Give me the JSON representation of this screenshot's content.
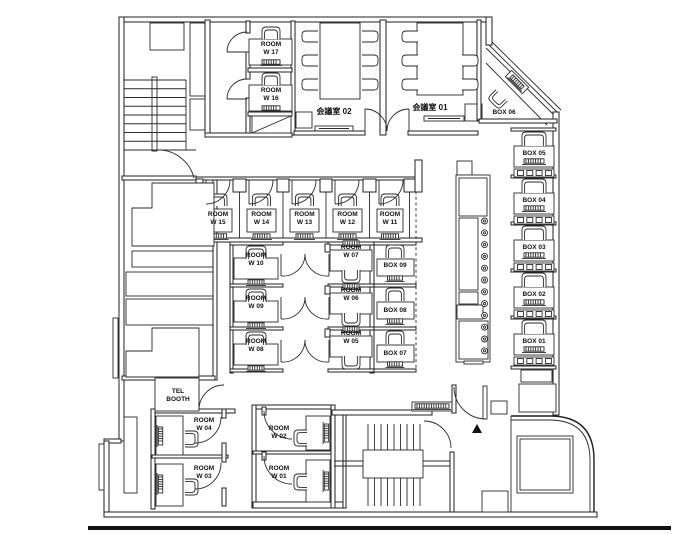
{
  "diagram": {
    "type": "office-floor-plan",
    "entrance_marker": "▲",
    "colors": {
      "wall": "#1f1f1f",
      "floor": "#ffffff",
      "marker": "#000000"
    }
  },
  "rooms_summary": {
    "work_rooms": [
      "ROOM W 01",
      "ROOM W 02",
      "ROOM W 03",
      "ROOM W 04",
      "ROOM W 05",
      "ROOM W 06",
      "ROOM W 07",
      "ROOM W 08",
      "ROOM W 09",
      "ROOM W 10",
      "ROOM W 11",
      "ROOM W 12",
      "ROOM W 13",
      "ROOM W 14",
      "ROOM W 15",
      "ROOM W 16",
      "ROOM W 17"
    ],
    "box_seats": [
      "BOX 01",
      "BOX 02",
      "BOX 03",
      "BOX 04",
      "BOX 05",
      "BOX 06",
      "BOX 07",
      "BOX 08",
      "BOX 09"
    ],
    "meeting_rooms": [
      "会議室 01",
      "会議室 02"
    ],
    "phone_booth": "TEL BOOTH"
  },
  "labels": [
    {
      "name": "room-w17-label",
      "text": "ROOM\nW 17",
      "x": 271,
      "y": 41
    },
    {
      "name": "room-w16-label",
      "text": "ROOM\nW 16",
      "x": 271,
      "y": 87
    },
    {
      "name": "meeting-room-02-label",
      "text": "会議室 02",
      "x": 334,
      "y": 107,
      "fs": 8
    },
    {
      "name": "meeting-room-01-label",
      "text": "会議室 01",
      "x": 430,
      "y": 103,
      "fs": 8
    },
    {
      "name": "box-06-label",
      "text": "BOX 06",
      "x": 504,
      "y": 109
    },
    {
      "name": "box-05-label",
      "text": "BOX 05",
      "x": 534,
      "y": 150
    },
    {
      "name": "box-04-label",
      "text": "BOX 04",
      "x": 534,
      "y": 197
    },
    {
      "name": "box-03-label",
      "text": "BOX 03",
      "x": 534,
      "y": 244
    },
    {
      "name": "box-02-label",
      "text": "BOX 02",
      "x": 534,
      "y": 291
    },
    {
      "name": "box-01-label",
      "text": "BOX 01",
      "x": 534,
      "y": 338
    },
    {
      "name": "room-w15-label",
      "text": "ROOM\nW 15",
      "x": 218,
      "y": 211
    },
    {
      "name": "room-w14-label",
      "text": "ROOM\nW 14",
      "x": 261.5,
      "y": 211
    },
    {
      "name": "room-w13-label",
      "text": "ROOM\nW 13",
      "x": 304.5,
      "y": 211
    },
    {
      "name": "room-w12-label",
      "text": "ROOM\nW 12",
      "x": 347.5,
      "y": 211
    },
    {
      "name": "room-w11-label",
      "text": "ROOM\nW 11",
      "x": 390,
      "y": 211
    },
    {
      "name": "room-w10-label",
      "text": "ROOM\nW 10",
      "x": 256,
      "y": 252
    },
    {
      "name": "room-w09-label",
      "text": "ROOM\nW 09",
      "x": 256,
      "y": 295
    },
    {
      "name": "room-w08-label",
      "text": "ROOM\nW 08",
      "x": 256,
      "y": 338
    },
    {
      "name": "room-w07-label",
      "text": "ROOM\nW 07",
      "x": 351,
      "y": 244
    },
    {
      "name": "room-w06-label",
      "text": "ROOM\nW 06",
      "x": 351,
      "y": 287
    },
    {
      "name": "room-w05-label",
      "text": "ROOM\nW 05",
      "x": 351,
      "y": 330
    },
    {
      "name": "box-09-label",
      "text": "BOX 09",
      "x": 395,
      "y": 262
    },
    {
      "name": "box-08-label",
      "text": "BOX 08",
      "x": 395,
      "y": 307
    },
    {
      "name": "box-07-label",
      "text": "BOX 07",
      "x": 395,
      "y": 350
    },
    {
      "name": "tel-booth-label",
      "text": "TEL\nBOOTH",
      "x": 178,
      "y": 388
    },
    {
      "name": "room-w04-label",
      "text": "ROOM\nW 04",
      "x": 204,
      "y": 417
    },
    {
      "name": "room-w03-label",
      "text": "ROOM\nW 03",
      "x": 204,
      "y": 465
    },
    {
      "name": "room-w02-label",
      "text": "ROOM\nW 02",
      "x": 279,
      "y": 425
    },
    {
      "name": "room-w01-label",
      "text": "ROOM\nW 01",
      "x": 279,
      "y": 465
    }
  ]
}
